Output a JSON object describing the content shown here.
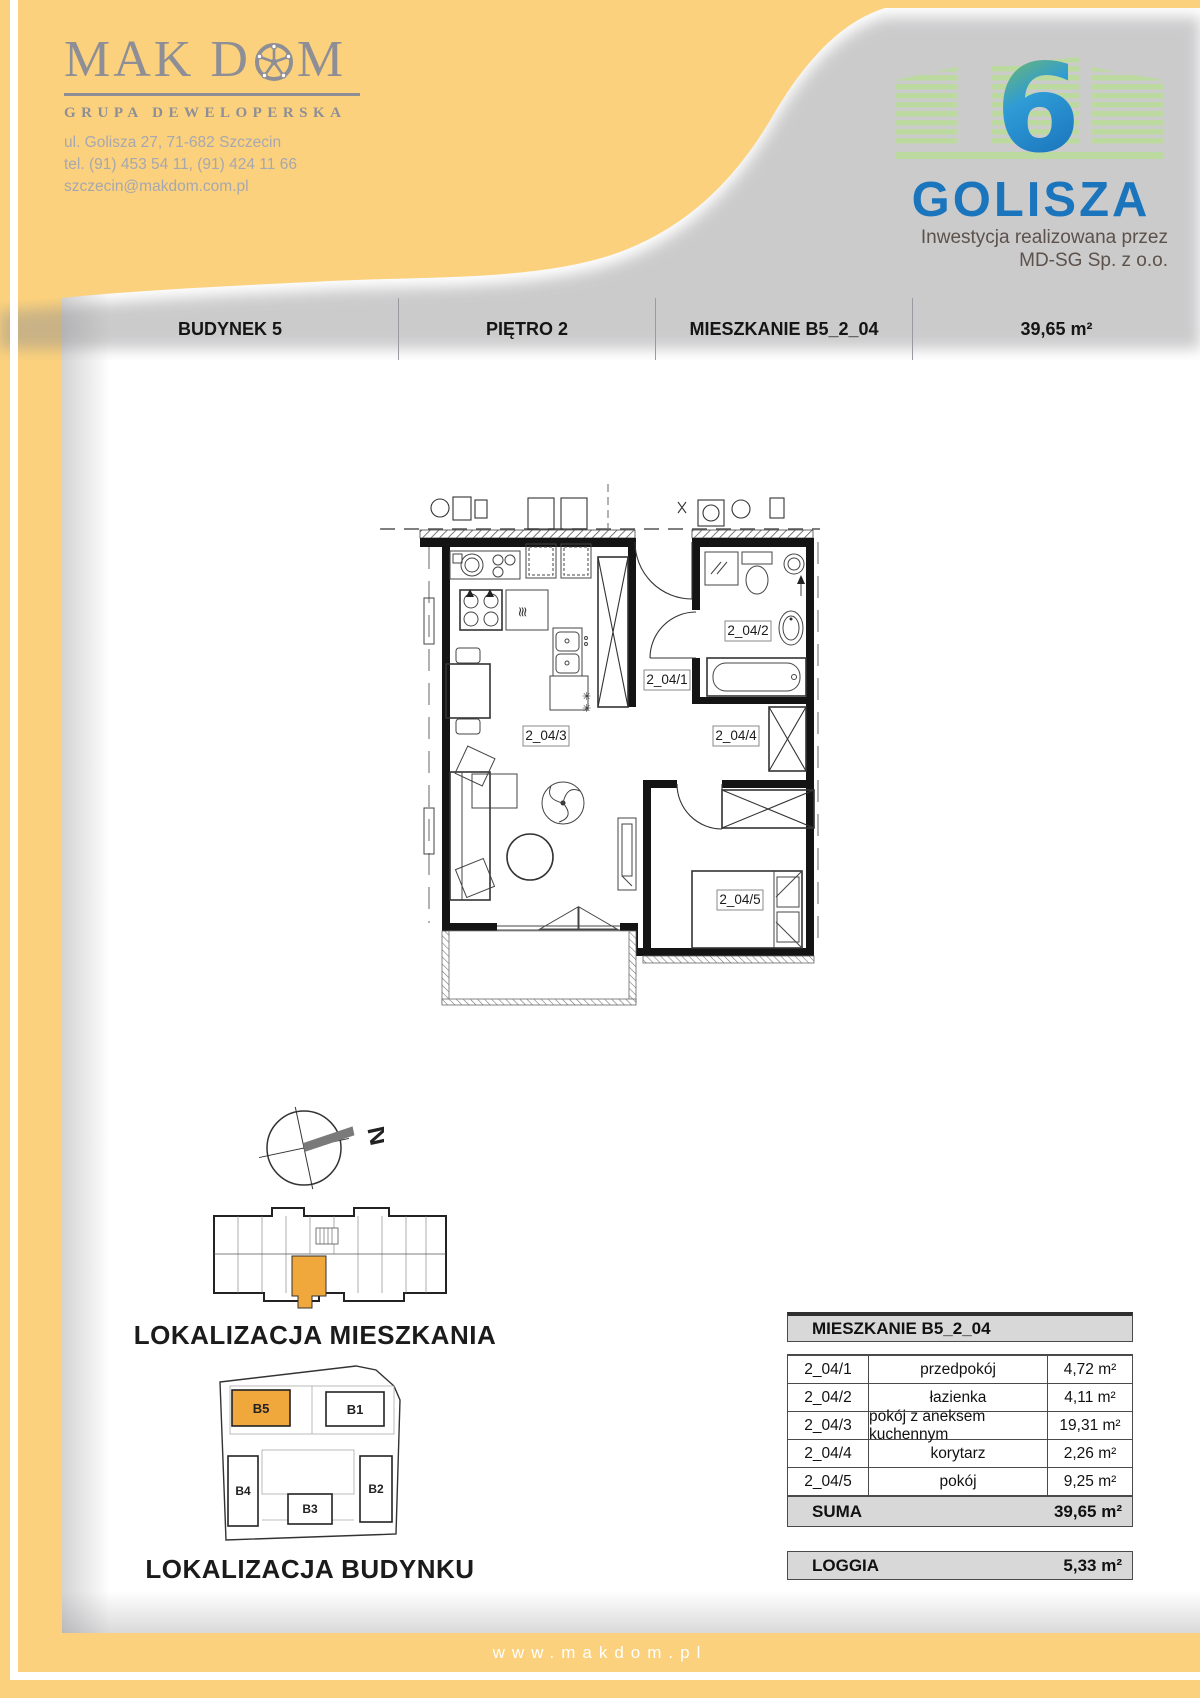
{
  "brand": {
    "logo_part1": "MAK D",
    "logo_part2": "M",
    "subtitle": "GRUPA DEWELOPERSKA",
    "address": "ul. Golisza 27, 71-682 Szczecin",
    "phone": "tel. (91) 453 54 11, (91) 424 11 66",
    "email": "szczecin@makdom.com.pl"
  },
  "project": {
    "number": "6",
    "name": "GOLISZA",
    "note_line1": "Inwestycja realizowana przez",
    "note_line2": "MD-SG Sp. z o.o."
  },
  "header": {
    "building": "BUDYNEK 5",
    "floor": "PIĘTRO 2",
    "apartment": "MIESZKANIE B5_2_04",
    "area": "39,65 m²"
  },
  "plan": {
    "room_labels": {
      "r1": "2_04/1",
      "r2": "2_04/2",
      "r3": "2_04/3",
      "r4": "2_04/4",
      "r5": "2_04/5"
    }
  },
  "locators": {
    "compass_letter": "N",
    "apartment_title": "LOKALIZACJA MIESZKANIA",
    "building_title": "LOKALIZACJA BUDYNKU",
    "buildings": {
      "b1": "B1",
      "b2": "B2",
      "b3": "B3",
      "b4": "B4",
      "b5": "B5"
    }
  },
  "table": {
    "title": "MIESZKANIE B5_2_04",
    "rows": [
      {
        "id": "2_04/1",
        "name": "przedpokój",
        "area": "4,72 m²"
      },
      {
        "id": "2_04/2",
        "name": "łazienka",
        "area": "4,11 m²"
      },
      {
        "id": "2_04/3",
        "name": "pokój z aneksem kuchennym",
        "area": "19,31 m²"
      },
      {
        "id": "2_04/4",
        "name": "korytarz",
        "area": "2,26 m²"
      },
      {
        "id": "2_04/5",
        "name": "pokój",
        "area": "9,25 m²"
      }
    ],
    "suma_label": "SUMA",
    "suma_value": "39,65 m²",
    "loggia_label": "LOGGIA",
    "loggia_value": "5,33 m²"
  },
  "footer": {
    "url": "www.makdom.pl"
  },
  "colors": {
    "accent_yellow": "#FBD17D",
    "highlight_orange": "#F0A73C",
    "brand_blue": "#1B75BC",
    "brand_green": "#BCD9A0",
    "logo_gray": "#8E8E96"
  }
}
